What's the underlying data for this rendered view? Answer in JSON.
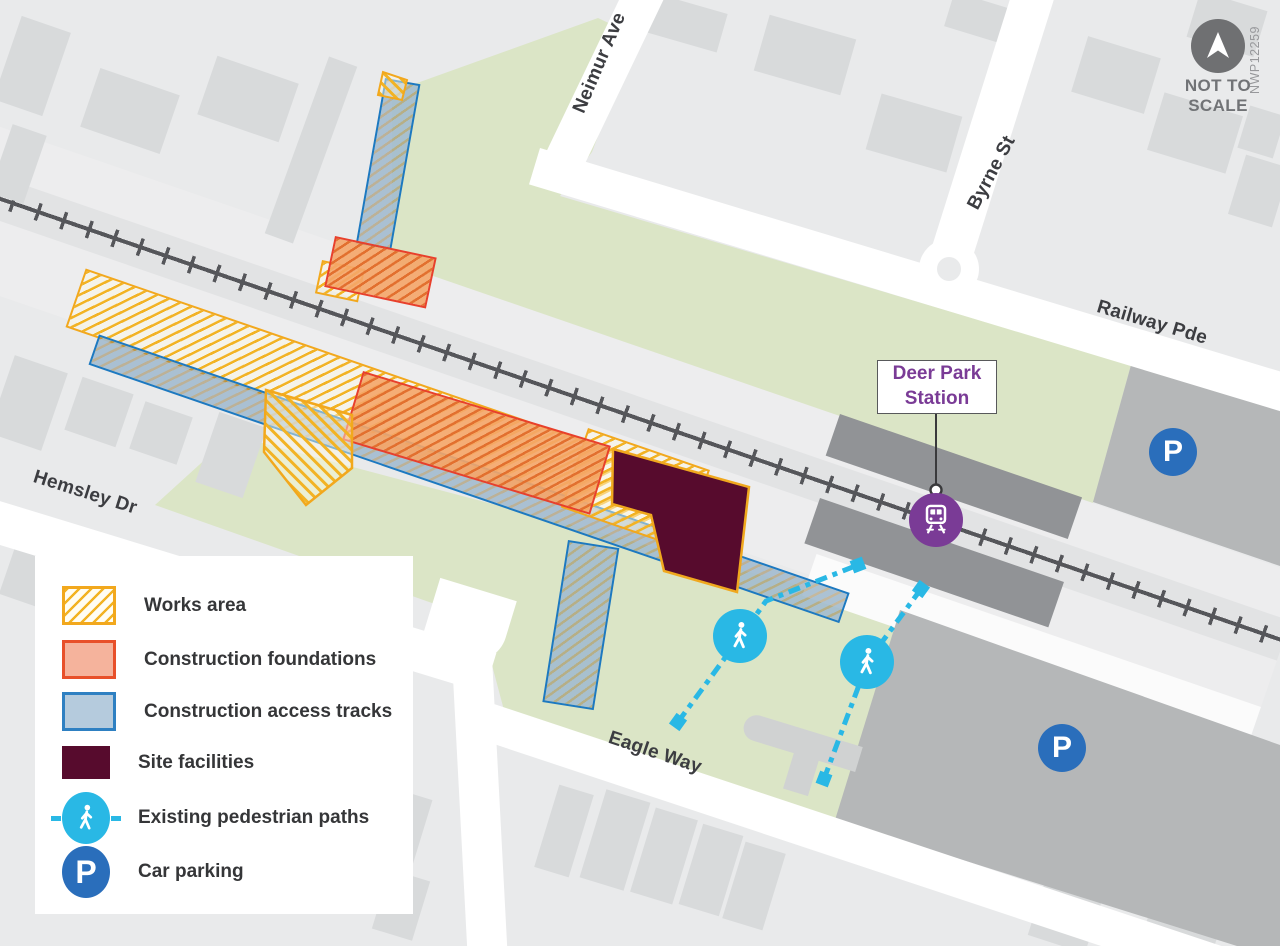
{
  "map": {
    "station_label": "Deer Park Station",
    "streets": {
      "neimur": "Neimur Ave",
      "byrne": "Byrne St",
      "railway": "Railway Pde",
      "hemsley": "Hemsley Dr",
      "eagle": "Eagle Way"
    },
    "scale_note": "NOT TO SCALE",
    "ref_code": "NWP12259",
    "parking_symbol": "P"
  },
  "legend": {
    "items": [
      {
        "label": "Works area",
        "swatch": "yellow-hatch",
        "color": "#f2a81d"
      },
      {
        "label": "Construction foundations",
        "swatch": "solid-salmon",
        "color": "#e8502a"
      },
      {
        "label": "Construction access tracks",
        "swatch": "solid-lightblue",
        "color": "#2e80c2"
      },
      {
        "label": "Site facilities",
        "swatch": "solid-maroon",
        "color": "#570b2d"
      },
      {
        "label": "Existing pedestrian paths",
        "swatch": "ped-icon",
        "color": "#29b8e5"
      },
      {
        "label": "Car parking",
        "swatch": "parking-icon",
        "color": "#2a6ebb"
      }
    ]
  },
  "colors": {
    "background": "#e9eaeb",
    "building": "#d8dadb",
    "green_area": "#dbe5c6",
    "road": "#ffffff",
    "rail_track": "#55565a",
    "platform": "#919396",
    "parking_area": "#b5b7b8",
    "station_purple": "#7a3b96",
    "pedestrian_cyan": "#29b8e5",
    "parking_blue": "#2a6ebb",
    "facilities_maroon": "#570b2d"
  }
}
